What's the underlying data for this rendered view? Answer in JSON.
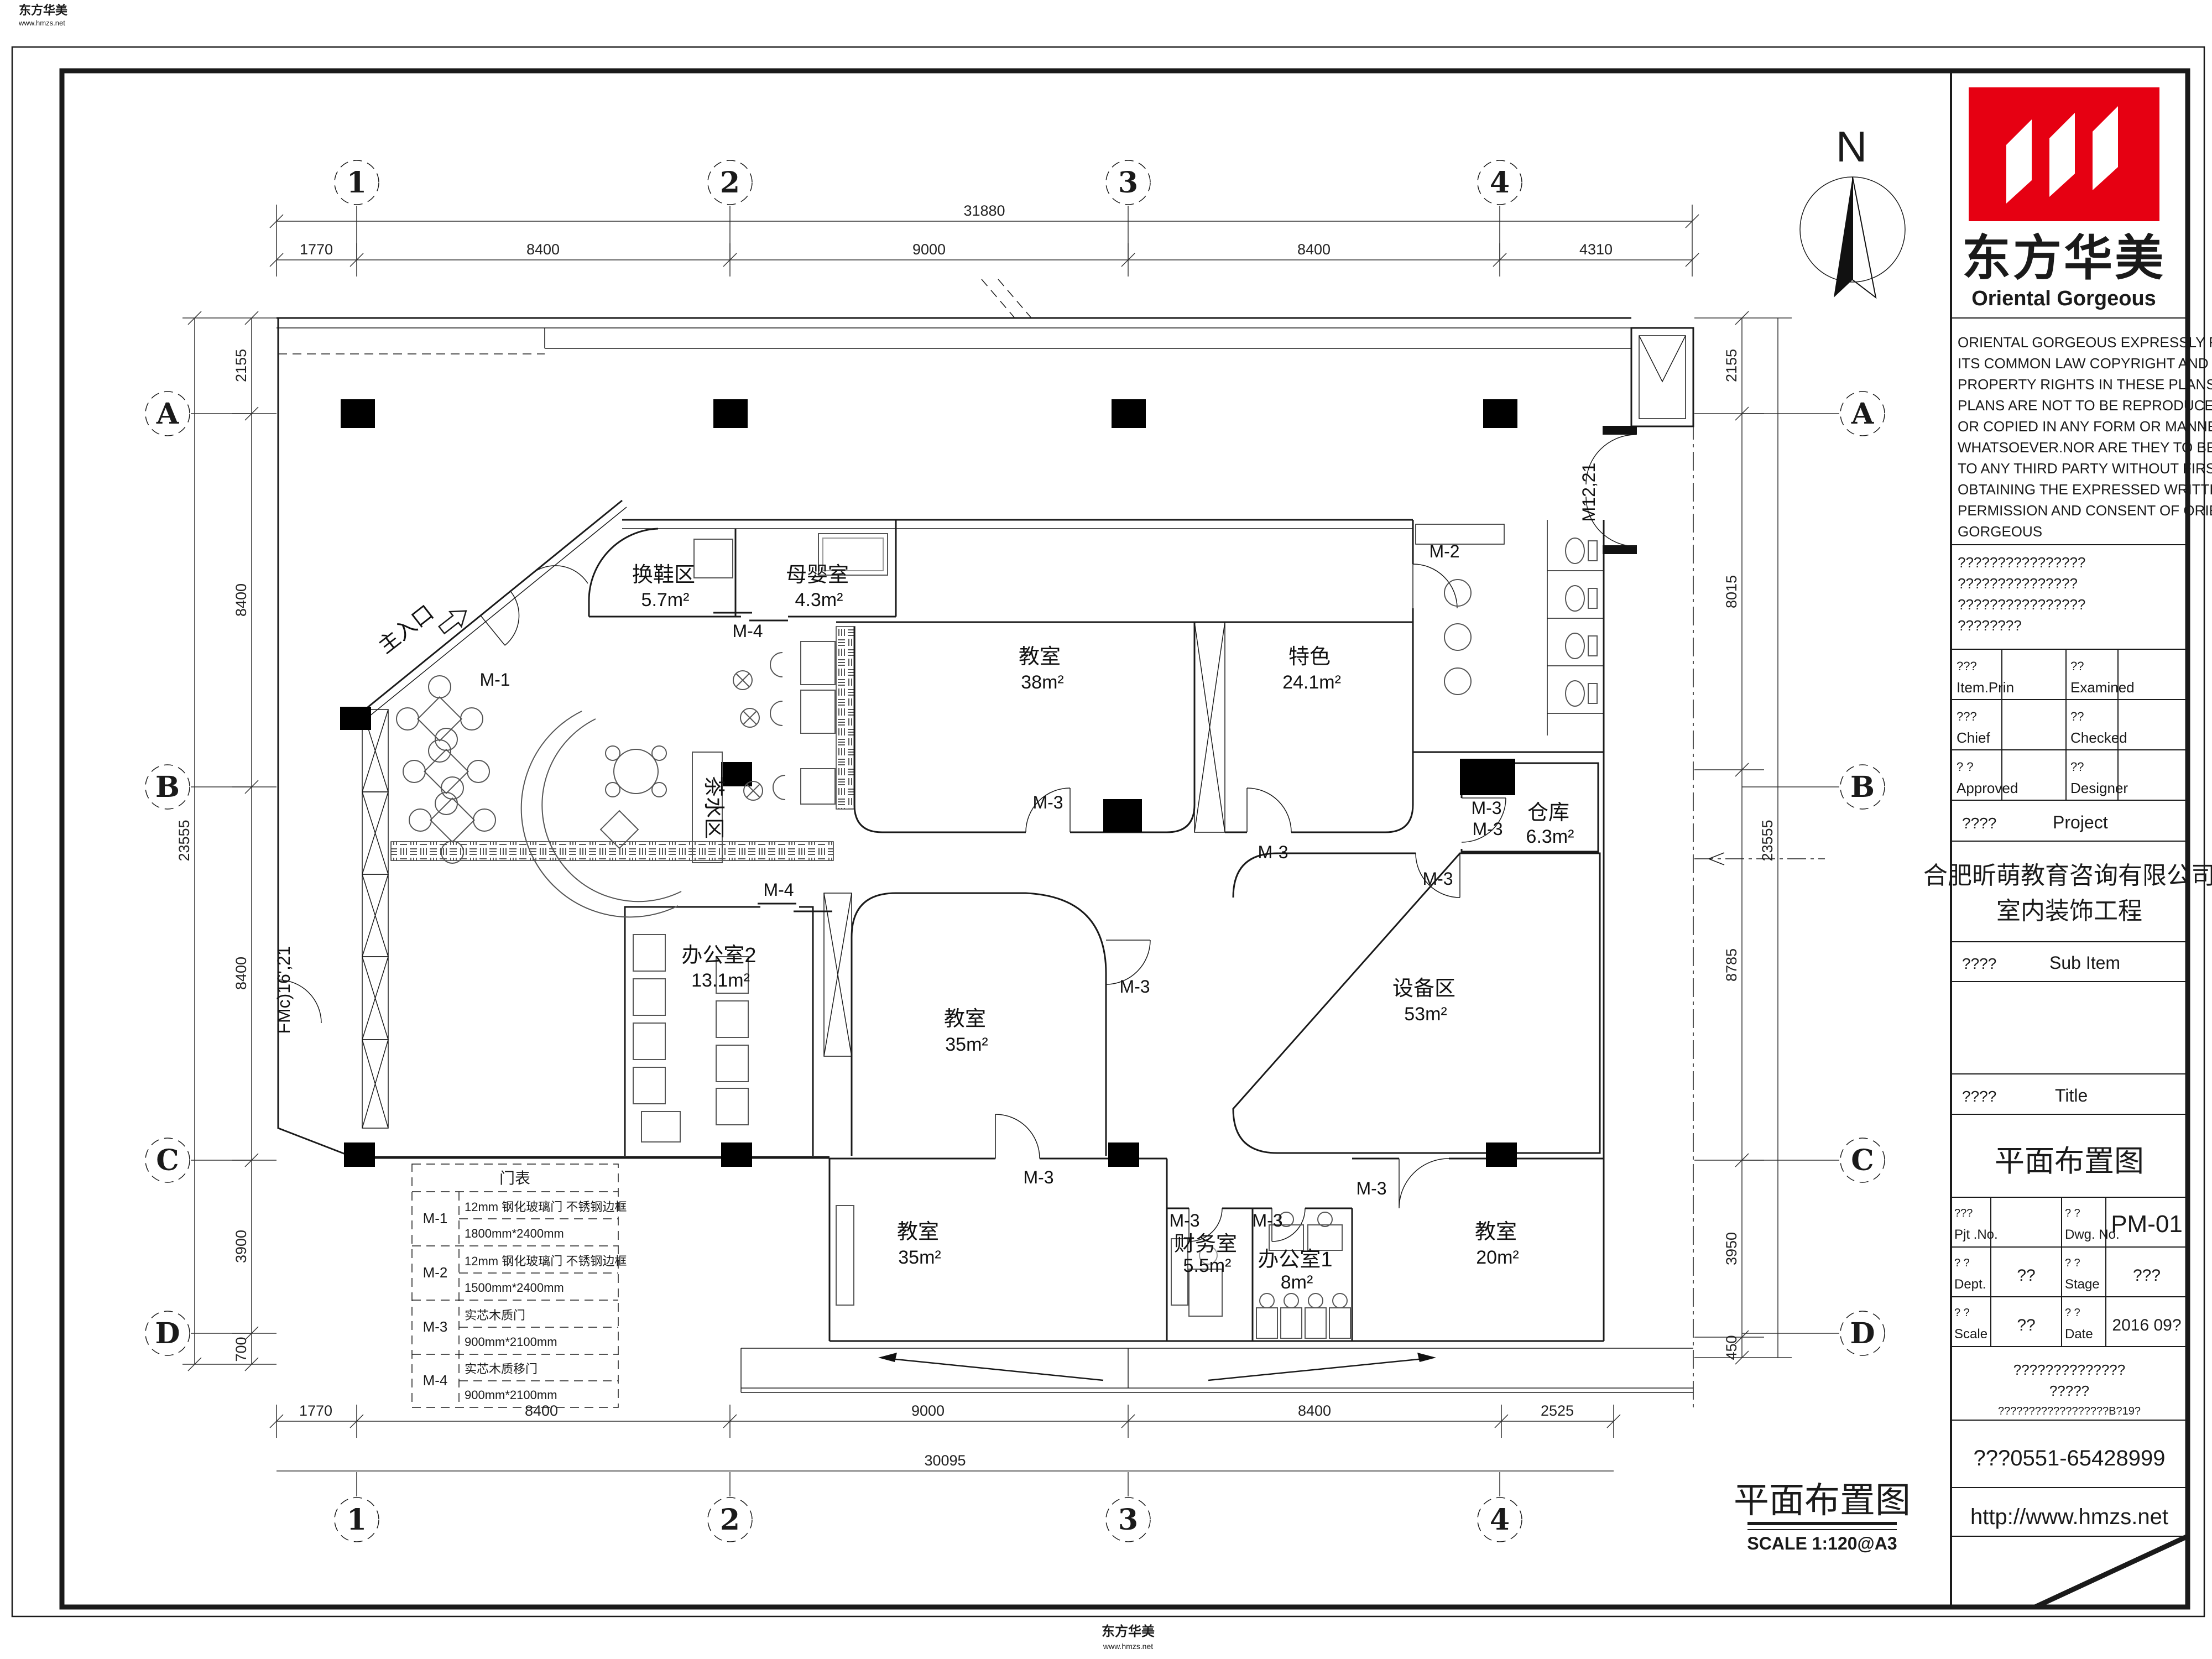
{
  "colors": {
    "line": "#1a1a1a",
    "red": "#e60012"
  },
  "watermark": {
    "brand": "东方华美",
    "url": "www.hmzs.net"
  },
  "north_label": "N",
  "plan_caption": {
    "title": "平面布置图",
    "scale": "SCALE 1:120@A3"
  },
  "grid": {
    "cols": [
      "1",
      "2",
      "3",
      "4"
    ],
    "rows": [
      "A",
      "B",
      "C",
      "D"
    ],
    "top_total": "31880",
    "top": [
      "1770",
      "8400",
      "9000",
      "8400",
      "4310"
    ],
    "bottom": [
      "1770",
      "8400",
      "9000",
      "8400",
      "2525"
    ],
    "bottom_total": "30095",
    "left": [
      "2155",
      "8400",
      "8400",
      "3900",
      "700"
    ],
    "left_total": "23555",
    "right": [
      "2155",
      "8015",
      "8785",
      "3950",
      "450"
    ],
    "right_total": "23555"
  },
  "rooms": [
    {
      "name": "换鞋区",
      "area": "5.7m²"
    },
    {
      "name": "母婴室",
      "area": "4.3m²"
    },
    {
      "name": "教室",
      "area": "38m²"
    },
    {
      "name": "特色",
      "area": "24.1m²"
    },
    {
      "name": "仓库",
      "area": "6.3m²"
    },
    {
      "name": "办公室2",
      "area": "13.1m²"
    },
    {
      "name": "教室",
      "area": "35m²"
    },
    {
      "name": "设备区",
      "area": "53m²"
    },
    {
      "name": "教室",
      "area": "35m²"
    },
    {
      "name": "财务室",
      "area": "5.5m²"
    },
    {
      "name": "办公室1",
      "area": "8m²"
    },
    {
      "name": "教室",
      "area": "20m²"
    },
    {
      "name": "茶水区",
      "area": ""
    },
    {
      "name": "主入口",
      "area": ""
    }
  ],
  "door_marks": {
    "m1": "M-1",
    "m2": "M-2",
    "m3": "M-3",
    "m4": "M-4",
    "m12": "M12,21",
    "fm": "FMc)16',21"
  },
  "door_schedule": {
    "title": "门表",
    "rows": [
      {
        "code": "M-1",
        "desc": "12mm 钢化玻璃门 不锈钢边框",
        "size": "1800mm*2400mm"
      },
      {
        "code": "M-2",
        "desc": "12mm 钢化玻璃门 不锈钢边框",
        "size": "1500mm*2400mm"
      },
      {
        "code": "M-3",
        "desc": "实芯木质门",
        "size": "900mm*2100mm"
      },
      {
        "code": "M-4",
        "desc": "实芯木质移门",
        "size": "900mm*2100mm"
      }
    ]
  },
  "title_block": {
    "logo": {
      "cn": "东方华美",
      "en": "Oriental Gorgeous"
    },
    "copyright": [
      "ORIENTAL GORGEOUS EXPRESSLY RESERV",
      "ITS COMMON LAW COPYRIGHT AND OTHE",
      "PROPERTY RIGHTS IN THESE PLANS.THES",
      "PLANS ARE NOT TO BE REPRODUCED CH",
      "OR COPIED IN ANY FORM OR MANNER",
      "WHATSOEVER.NOR ARE THEY TO BE ASS",
      "TO ANY THIRD PARTY WITHOUT FIRST",
      "OBTAINING THE EXPRESSED WRITTEN",
      "PERMISSION AND CONSENT OF ORIENTAL",
      "GORGEOUS"
    ],
    "notice": [
      "????????????????",
      "???????????????",
      "????????????????",
      "????????"
    ],
    "personnel": [
      {
        "cn": "???",
        "en": "Item.Prin",
        "value": ""
      },
      {
        "cn": "??",
        "en": "Examined",
        "value": ""
      },
      {
        "cn": "???",
        "en": "Chief",
        "value": ""
      },
      {
        "cn": "??",
        "en": "Checked",
        "value": ""
      },
      {
        "cn": "? ?",
        "en": "Approved",
        "value": ""
      },
      {
        "cn": "??",
        "en": "Designer",
        "value": ""
      }
    ],
    "project": {
      "cn": "????",
      "en": "Project",
      "name1": "合肥昕萌教育咨询有限公司",
      "name2": "室内装饰工程"
    },
    "sub_item": {
      "cn": "????",
      "en": "Sub Item",
      "value": ""
    },
    "title_row": {
      "cn": "????",
      "en": "Title",
      "value": "平面布置图"
    },
    "info": {
      "pjt": {
        "cn": "???",
        "en": "Pjt .No.",
        "value": ""
      },
      "dwg": {
        "cn": "? ?",
        "en": "Dwg. No.",
        "value": "PM-01"
      },
      "dept": {
        "cn": "? ?",
        "en": "Dept.",
        "value": "??"
      },
      "stage": {
        "cn": "? ?",
        "en": "Stage",
        "value": "???"
      },
      "scale": {
        "cn": "? ?",
        "en": "Scale",
        "value": "??"
      },
      "date": {
        "cn": "? ?",
        "en": "Date",
        "value": "2016 09?"
      }
    },
    "footer": {
      "line1": "??????????????",
      "line2": "?????",
      "line3": "??????????????????B?19?",
      "phone": "???0551-65428999",
      "url": "http://www.hmzs.net"
    }
  }
}
